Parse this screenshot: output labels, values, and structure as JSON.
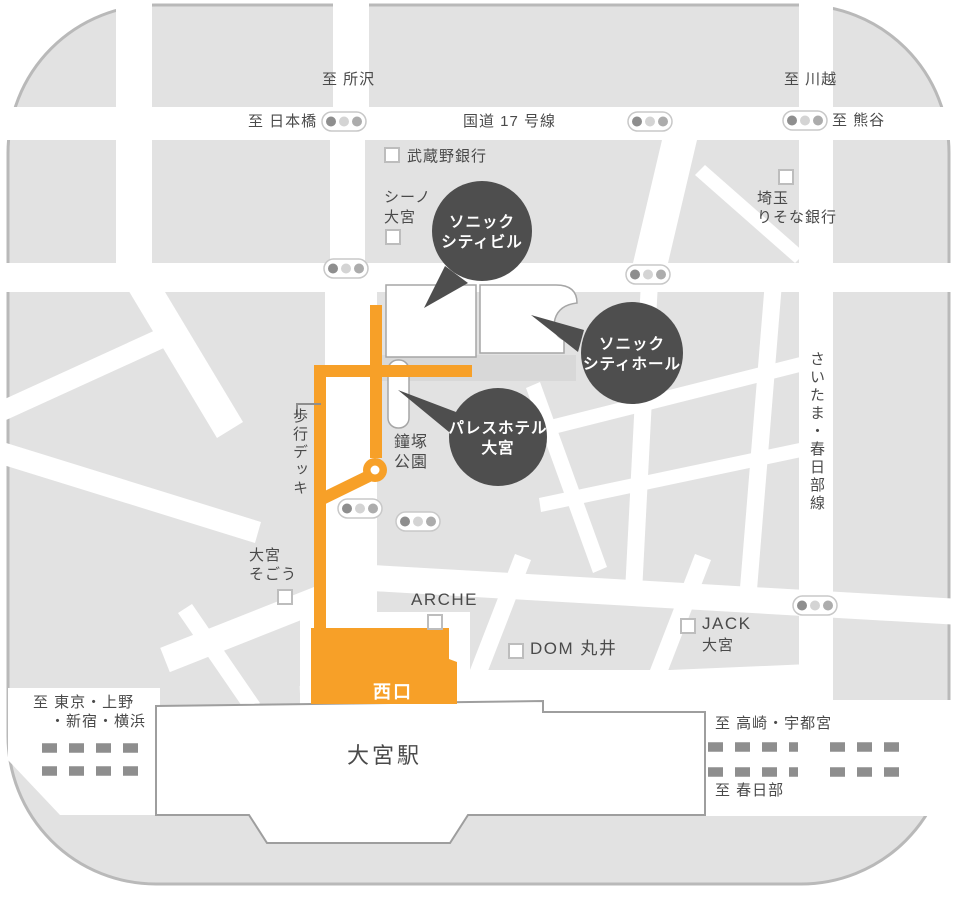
{
  "colors": {
    "map_gray": "#E2E2E2",
    "road_white": "#FFFFFF",
    "accent_orange": "#F7A028",
    "bubble_dark": "#4E4E4E",
    "text_gray": "#4A4A4A",
    "rail_gray": "#8E8E8E"
  },
  "labels": {
    "to_tokorozawa": "至 所沢",
    "to_kawagoe": "至 川越",
    "to_nihonbashi": "至 日本橋",
    "route_17": "国道 17 号線",
    "to_kumagaya": "至 熊谷",
    "musashino_bank": "武蔵野銀行",
    "scene_omiya_line1": "シーノ",
    "scene_omiya_line2": "大宮",
    "saitama_resona_line1": "埼玉",
    "saitama_resona_line2": "りそな銀行",
    "kanetsuka_park_line1": "鐘塚",
    "kanetsuka_park_line2": "公園",
    "pedestrian_deck": "歩行デッキ",
    "saitama_kasukabe_line": "さいたま・春日部線",
    "omiya_sogo_line1": "大宮",
    "omiya_sogo_line2": "そごう",
    "arche": "ARCHE",
    "dom_marui": "DOM 丸井",
    "jack_line1": "JACK",
    "jack_line2": "大宮",
    "west_exit": "西口",
    "omiya_station": "大宮駅",
    "to_tokyo_line1": "至 東京・上野",
    "to_tokyo_line2": "・新宿・横浜",
    "to_takasaki_utsunomiya": "至 高崎・宇都宮",
    "to_kasukabe": "至 春日部"
  },
  "bubbles": {
    "sonic_city_building": {
      "line1": "ソニック",
      "line2": "シティビル"
    },
    "sonic_city_hall": {
      "line1": "ソニック",
      "line2": "シティホール"
    },
    "palace_hotel": {
      "line1": "パレスホテル",
      "line2": "大宮"
    }
  },
  "icons": {
    "building_marker": "white-square",
    "traffic_light": "three-dot-pill",
    "route_node": "orange-ring"
  }
}
